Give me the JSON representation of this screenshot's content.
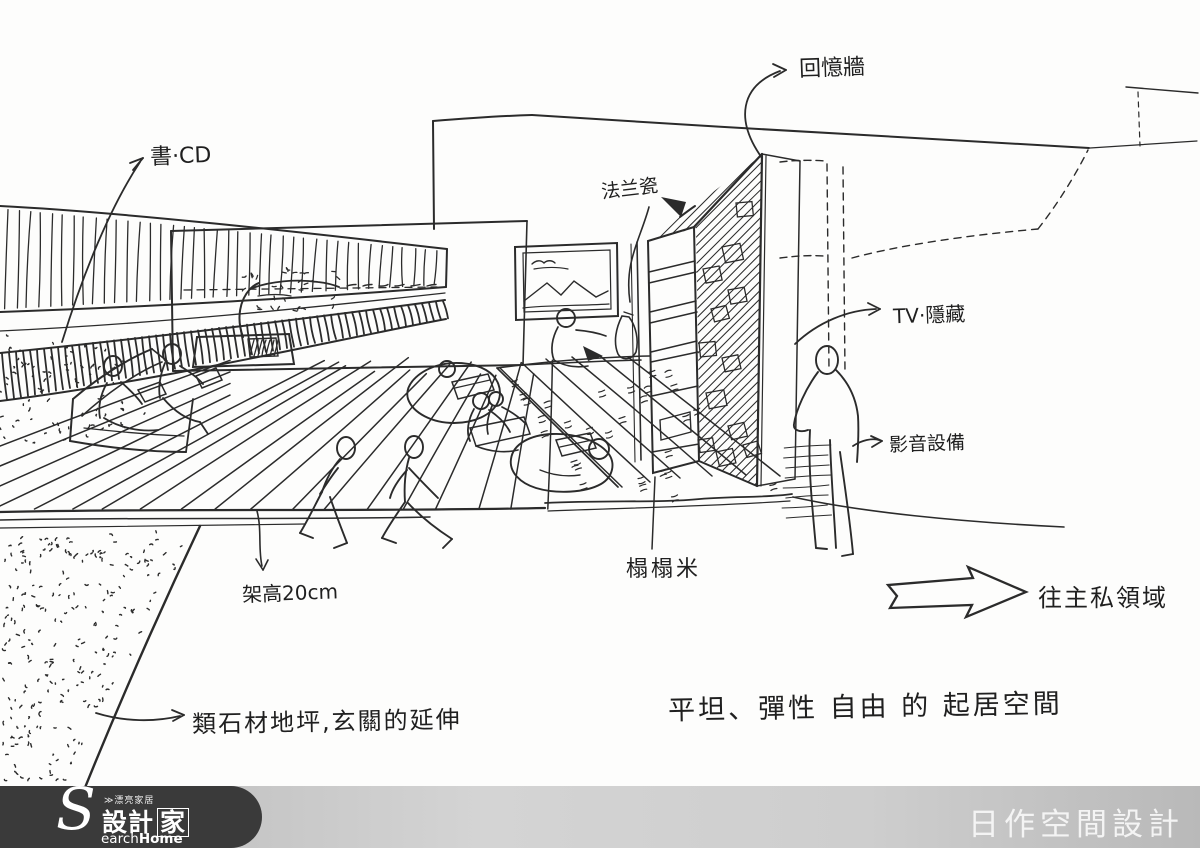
{
  "page": {
    "background": "#fdfdfc",
    "ink": "#2b2b2b"
  },
  "labels": {
    "book_cd": "書·CD",
    "memory_wall": "回憶牆",
    "franz_porcelain": "法兰瓷",
    "tv_hidden": "TV·隱藏",
    "av_equipment": "影音設備",
    "tatami": "榻榻米",
    "raised_floor": "架高20cm",
    "stone_floor": "類石材地坪,玄關的延伸",
    "living_space": "平坦、彈性 自由 的 起居空間",
    "to_private_area": "往主私領域"
  },
  "footer": {
    "brand_text": "日作空間設計",
    "logo": {
      "s": "S",
      "tagline": "≫漂亮家居",
      "name_left": "設計",
      "name_right": "家",
      "sub_light": "earch",
      "sub_bold": "Home"
    },
    "logo_bg": "#3a3a3a",
    "bar_color": "#cecece",
    "text_color": "#f4f4f4"
  }
}
